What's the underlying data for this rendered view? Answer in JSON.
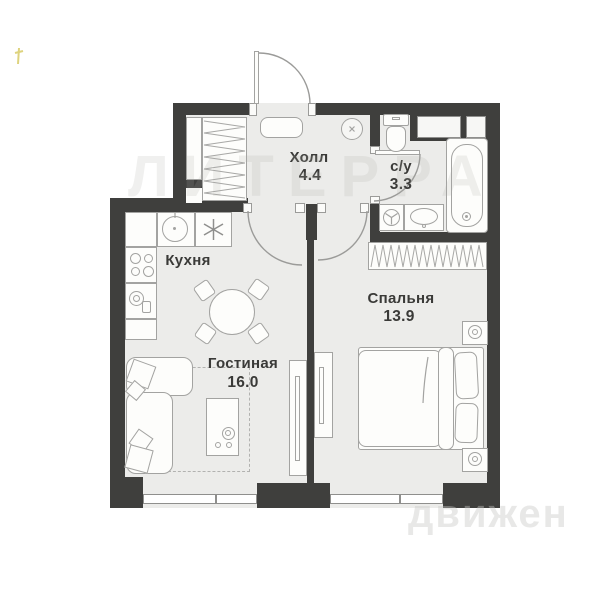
{
  "rooms": {
    "hall": {
      "name": "Холл",
      "area": "4.4"
    },
    "bathroom": {
      "name": "с/у",
      "area": "3.3"
    },
    "kitchen": {
      "name": "Кухня"
    },
    "living": {
      "name": "Гостиная",
      "area": "16.0"
    },
    "bedroom": {
      "name": "Спальня",
      "area": "13.9"
    }
  },
  "watermarks": {
    "center": "ЛИТЕРРА",
    "corner": "движен"
  },
  "colors": {
    "wall": "#3f3f3d",
    "floor": "#ececea",
    "line": "#a3a3a1",
    "text": "#3a3a38",
    "mark": "#d9cf6e"
  }
}
